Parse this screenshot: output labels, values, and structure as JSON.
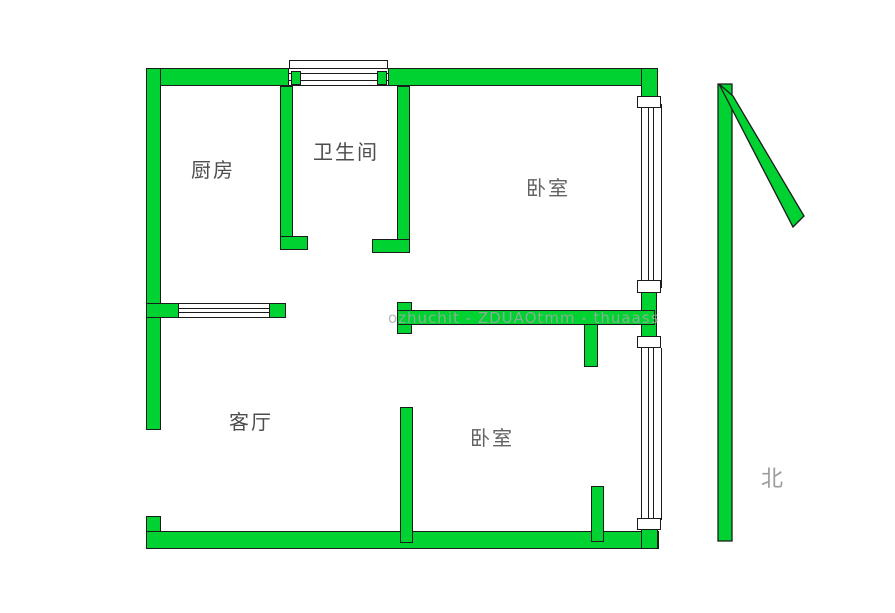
{
  "rooms": {
    "kitchen": {
      "label": "厨房"
    },
    "bathroom": {
      "label": "卫生间"
    },
    "bedroom_top": {
      "label": "卧室"
    },
    "living_room": {
      "label": "客厅"
    },
    "bedroom_bottom": {
      "label": "卧室"
    }
  },
  "compass": {
    "label": "北",
    "direction": "up"
  },
  "watermark": {
    "text": "ozhuchit - ZDUAOtmm - thuaass"
  },
  "colors": {
    "wall": "#00d232",
    "outline": "#1b1b1b",
    "room_label": "#4d4d4d",
    "compass_label": "#9b9b9b",
    "watermark": "#a8a8a8",
    "background": "#ffffff"
  }
}
